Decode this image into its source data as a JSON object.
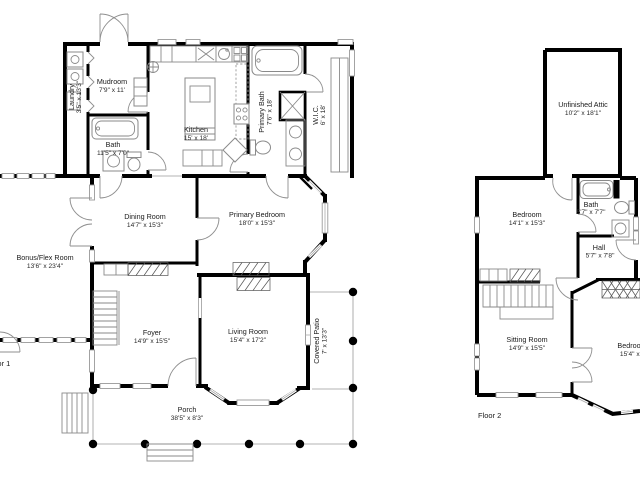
{
  "colors": {
    "background": "#ffffff",
    "walls": "#000000",
    "details": "#8a8a8a",
    "text": "#1a1a1a"
  },
  "floor1": {
    "label": "Floor 1",
    "rooms": {
      "mudroom": {
        "name": "Mudroom",
        "dims": "7'9\" x 11'"
      },
      "laundry": {
        "name": "Laundry",
        "dims": "3'5\" x 13'3\""
      },
      "bath": {
        "name": "Bath",
        "dims": "11'5\" x 7'0\""
      },
      "kitchen": {
        "name": "Kitchen",
        "dims": "15' x 18'"
      },
      "primary_bath": {
        "name": "Primary Bath",
        "dims": "7'6\" x 18'"
      },
      "wic": {
        "name": "W.I.C.",
        "dims": "6' x 18'"
      },
      "dining_room": {
        "name": "Dining Room",
        "dims": "14'7\" x 15'3\""
      },
      "primary_bedroom": {
        "name": "Primary Bedroom",
        "dims": "18'0\" x 15'3\""
      },
      "bonus_flex": {
        "name": "Bonus/Flex Room",
        "dims": "13'6\" x 23'4\""
      },
      "foyer": {
        "name": "Foyer",
        "dims": "14'9\" x 15'5\""
      },
      "living_room": {
        "name": "Living Room",
        "dims": "15'4\" x 17'2\""
      },
      "covered_patio": {
        "name": "Covered Patio",
        "dims": "7' x 13'3\""
      },
      "porch": {
        "name": "Porch",
        "dims": "38'5\" x 8'3\""
      }
    }
  },
  "floor2": {
    "label": "Floor 2",
    "rooms": {
      "unfinished_attic": {
        "name": "Unfinished Attic",
        "dims": "10'2\" x 18'1\""
      },
      "bath": {
        "name": "Bath",
        "dims": "5'7\" x 7'7\""
      },
      "bedroom": {
        "name": "Bedroom",
        "dims": "14'1\" x 15'3\""
      },
      "hall": {
        "name": "Hall",
        "dims": "5'7\" x 7'8\""
      },
      "sitting_room": {
        "name": "Sitting Room",
        "dims": "14'9\" x 15'5\""
      },
      "bedroom2": {
        "name": "Bedroom",
        "dims": "15'4\" x 17'2\""
      }
    }
  }
}
